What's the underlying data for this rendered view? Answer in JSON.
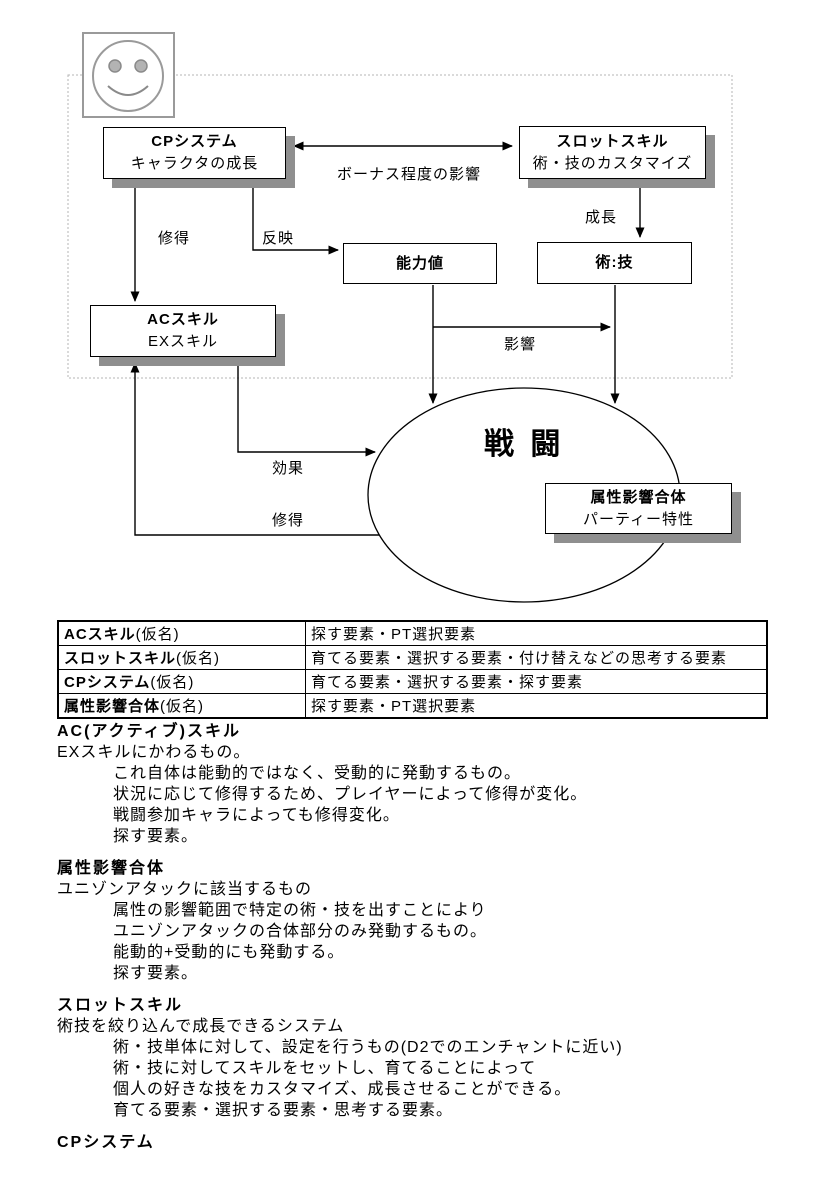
{
  "diagram": {
    "smiley_icon": "smiley-face-icon",
    "battle": {
      "label": "戦 闘"
    },
    "nodes": {
      "cp": {
        "title": "CPシステム",
        "subtitle": "キャラクタの成長"
      },
      "slot": {
        "title": "スロットスキル",
        "subtitle": "術・技のカスタマイズ"
      },
      "ability": {
        "title": "能力値"
      },
      "arts": {
        "title": "術:技"
      },
      "ac": {
        "title": "ACスキル",
        "subtitle": "EXスキル"
      },
      "attr": {
        "title": "属性影響合体",
        "subtitle": "パーティー特性"
      }
    },
    "labels": {
      "bonus": "ボーナス程度の影響",
      "learn_top": "修得",
      "reflect": "反映",
      "growth": "成長",
      "influence": "影響",
      "effect": "効果",
      "learn_bottom": "修得"
    },
    "colors": {
      "line": "#000000",
      "box_shadow": "#8f8f8f",
      "dotted_border": "#b4b4b4",
      "smiley": "#9a9a9a"
    }
  },
  "table": {
    "rows": [
      {
        "name": "ACスキル",
        "suffix": "(仮名)",
        "desc": "探す要素・PT選択要素"
      },
      {
        "name": "スロットスキル",
        "suffix": "(仮名)",
        "desc": "育てる要素・選択する要素・付け替えなどの思考する要素"
      },
      {
        "name": "CPシステム",
        "suffix": "(仮名)",
        "desc": "育てる要素・選択する要素・探す要素"
      },
      {
        "name": "属性影響合体",
        "suffix": "(仮名)",
        "desc": "探す要素・PT選択要素"
      }
    ]
  },
  "sections": [
    {
      "heading": "AC(アクティブ)スキル",
      "intro": "EXスキルにかわるもの。",
      "lines": [
        "これ自体は能動的ではなく、受動的に発動するもの。",
        "状況に応じて修得するため、プレイヤーによって修得が変化。",
        "戦闘参加キャラによっても修得変化。",
        "探す要素。"
      ]
    },
    {
      "heading": "属性影響合体",
      "intro": "ユニゾンアタックに該当するもの",
      "lines": [
        "属性の影響範囲で特定の術・技を出すことにより",
        "ユニゾンアタックの合体部分のみ発動するもの。",
        "能動的+受動的にも発動する。",
        "探す要素。"
      ]
    },
    {
      "heading": "スロットスキル",
      "intro": "術技を絞り込んで成長できるシステム",
      "lines": [
        "術・技単体に対して、設定を行うもの(D2でのエンチャントに近い)",
        "術・技に対してスキルをセットし、育てることによって",
        "個人の好きな技をカスタマイズ、成長させることができる。",
        "育てる要素・選択する要素・思考する要素。"
      ]
    },
    {
      "heading": "CPシステム"
    }
  ]
}
